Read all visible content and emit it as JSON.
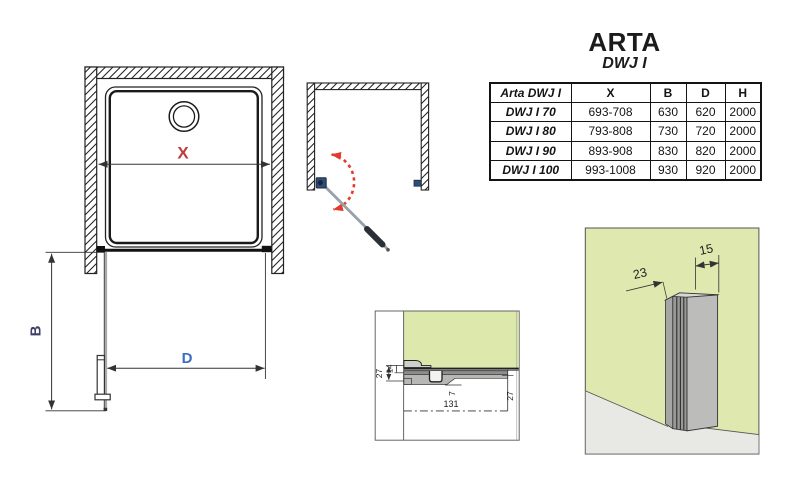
{
  "title": {
    "brand": "ARTA",
    "model": "DWJ I"
  },
  "table": {
    "headers": {
      "product": "Arta DWJ I",
      "x": "X",
      "b": "B",
      "d": "D",
      "h": "H"
    },
    "rows": [
      {
        "name": "DWJ I 70",
        "x": "693-708",
        "b": "630",
        "d": "620",
        "h": "2000"
      },
      {
        "name": "DWJ I 80",
        "x": "793-808",
        "b": "730",
        "d": "720",
        "h": "2000"
      },
      {
        "name": "DWJ I 90",
        "x": "893-908",
        "b": "830",
        "d": "820",
        "h": "2000"
      },
      {
        "name": "DWJ I 100",
        "x": "993-1008",
        "b": "930",
        "d": "920",
        "h": "2000"
      }
    ]
  },
  "plan_view": {
    "width_label": "X",
    "height_label": "B",
    "door_width_label": "D"
  },
  "sill_detail": {
    "total_height": "27",
    "inner_height": "14",
    "lip": "7",
    "profile_length": "131",
    "right_height": "27"
  },
  "wall_profile_detail": {
    "depth": "23",
    "width": "15"
  },
  "colors": {
    "dim_x_red": "#c23b3b",
    "dim_b_navy": "#3f3f68",
    "dim_d_blue": "#3a6dbd",
    "table_x_red": "#c03636",
    "table_bd_blue": "#33669c",
    "table_h_gold": "#c8a23c",
    "glass_green": "#dde8ad",
    "hinge_navy": "#2f4e74",
    "swing_arc_red": "#e23b2e"
  }
}
